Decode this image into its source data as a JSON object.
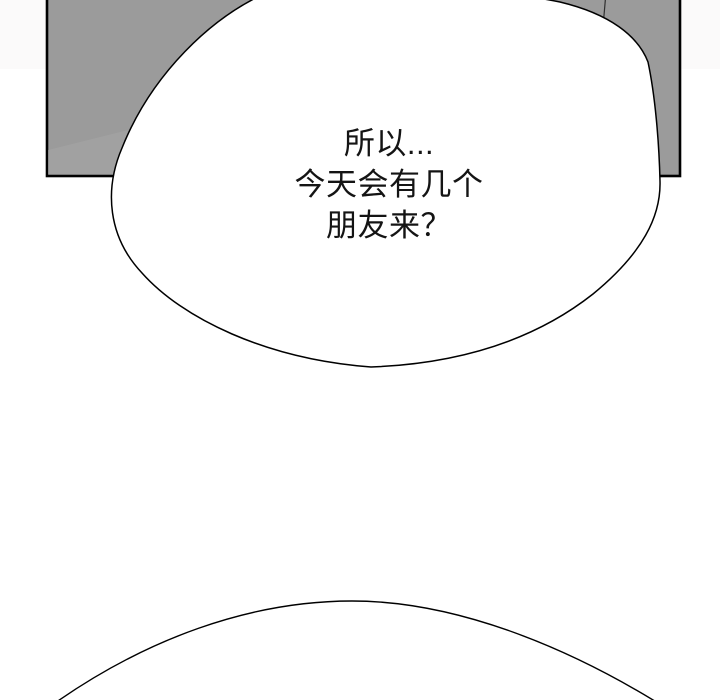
{
  "page": {
    "background_color": "#ffffff",
    "top_strip_color": "#fbfafa"
  },
  "panel": {
    "fill_color": "#9b9b9b",
    "border_color": "#000000",
    "shading_color": "#a8a8a8"
  },
  "speech_bubble": {
    "fill_color": "#ffffff",
    "stroke_color": "#000000",
    "lines": [
      "所以...",
      "今天会有几个",
      "朋友来？"
    ]
  },
  "next_bubble": {
    "fill_color": "#ffffff",
    "stroke_color": "#000000"
  }
}
